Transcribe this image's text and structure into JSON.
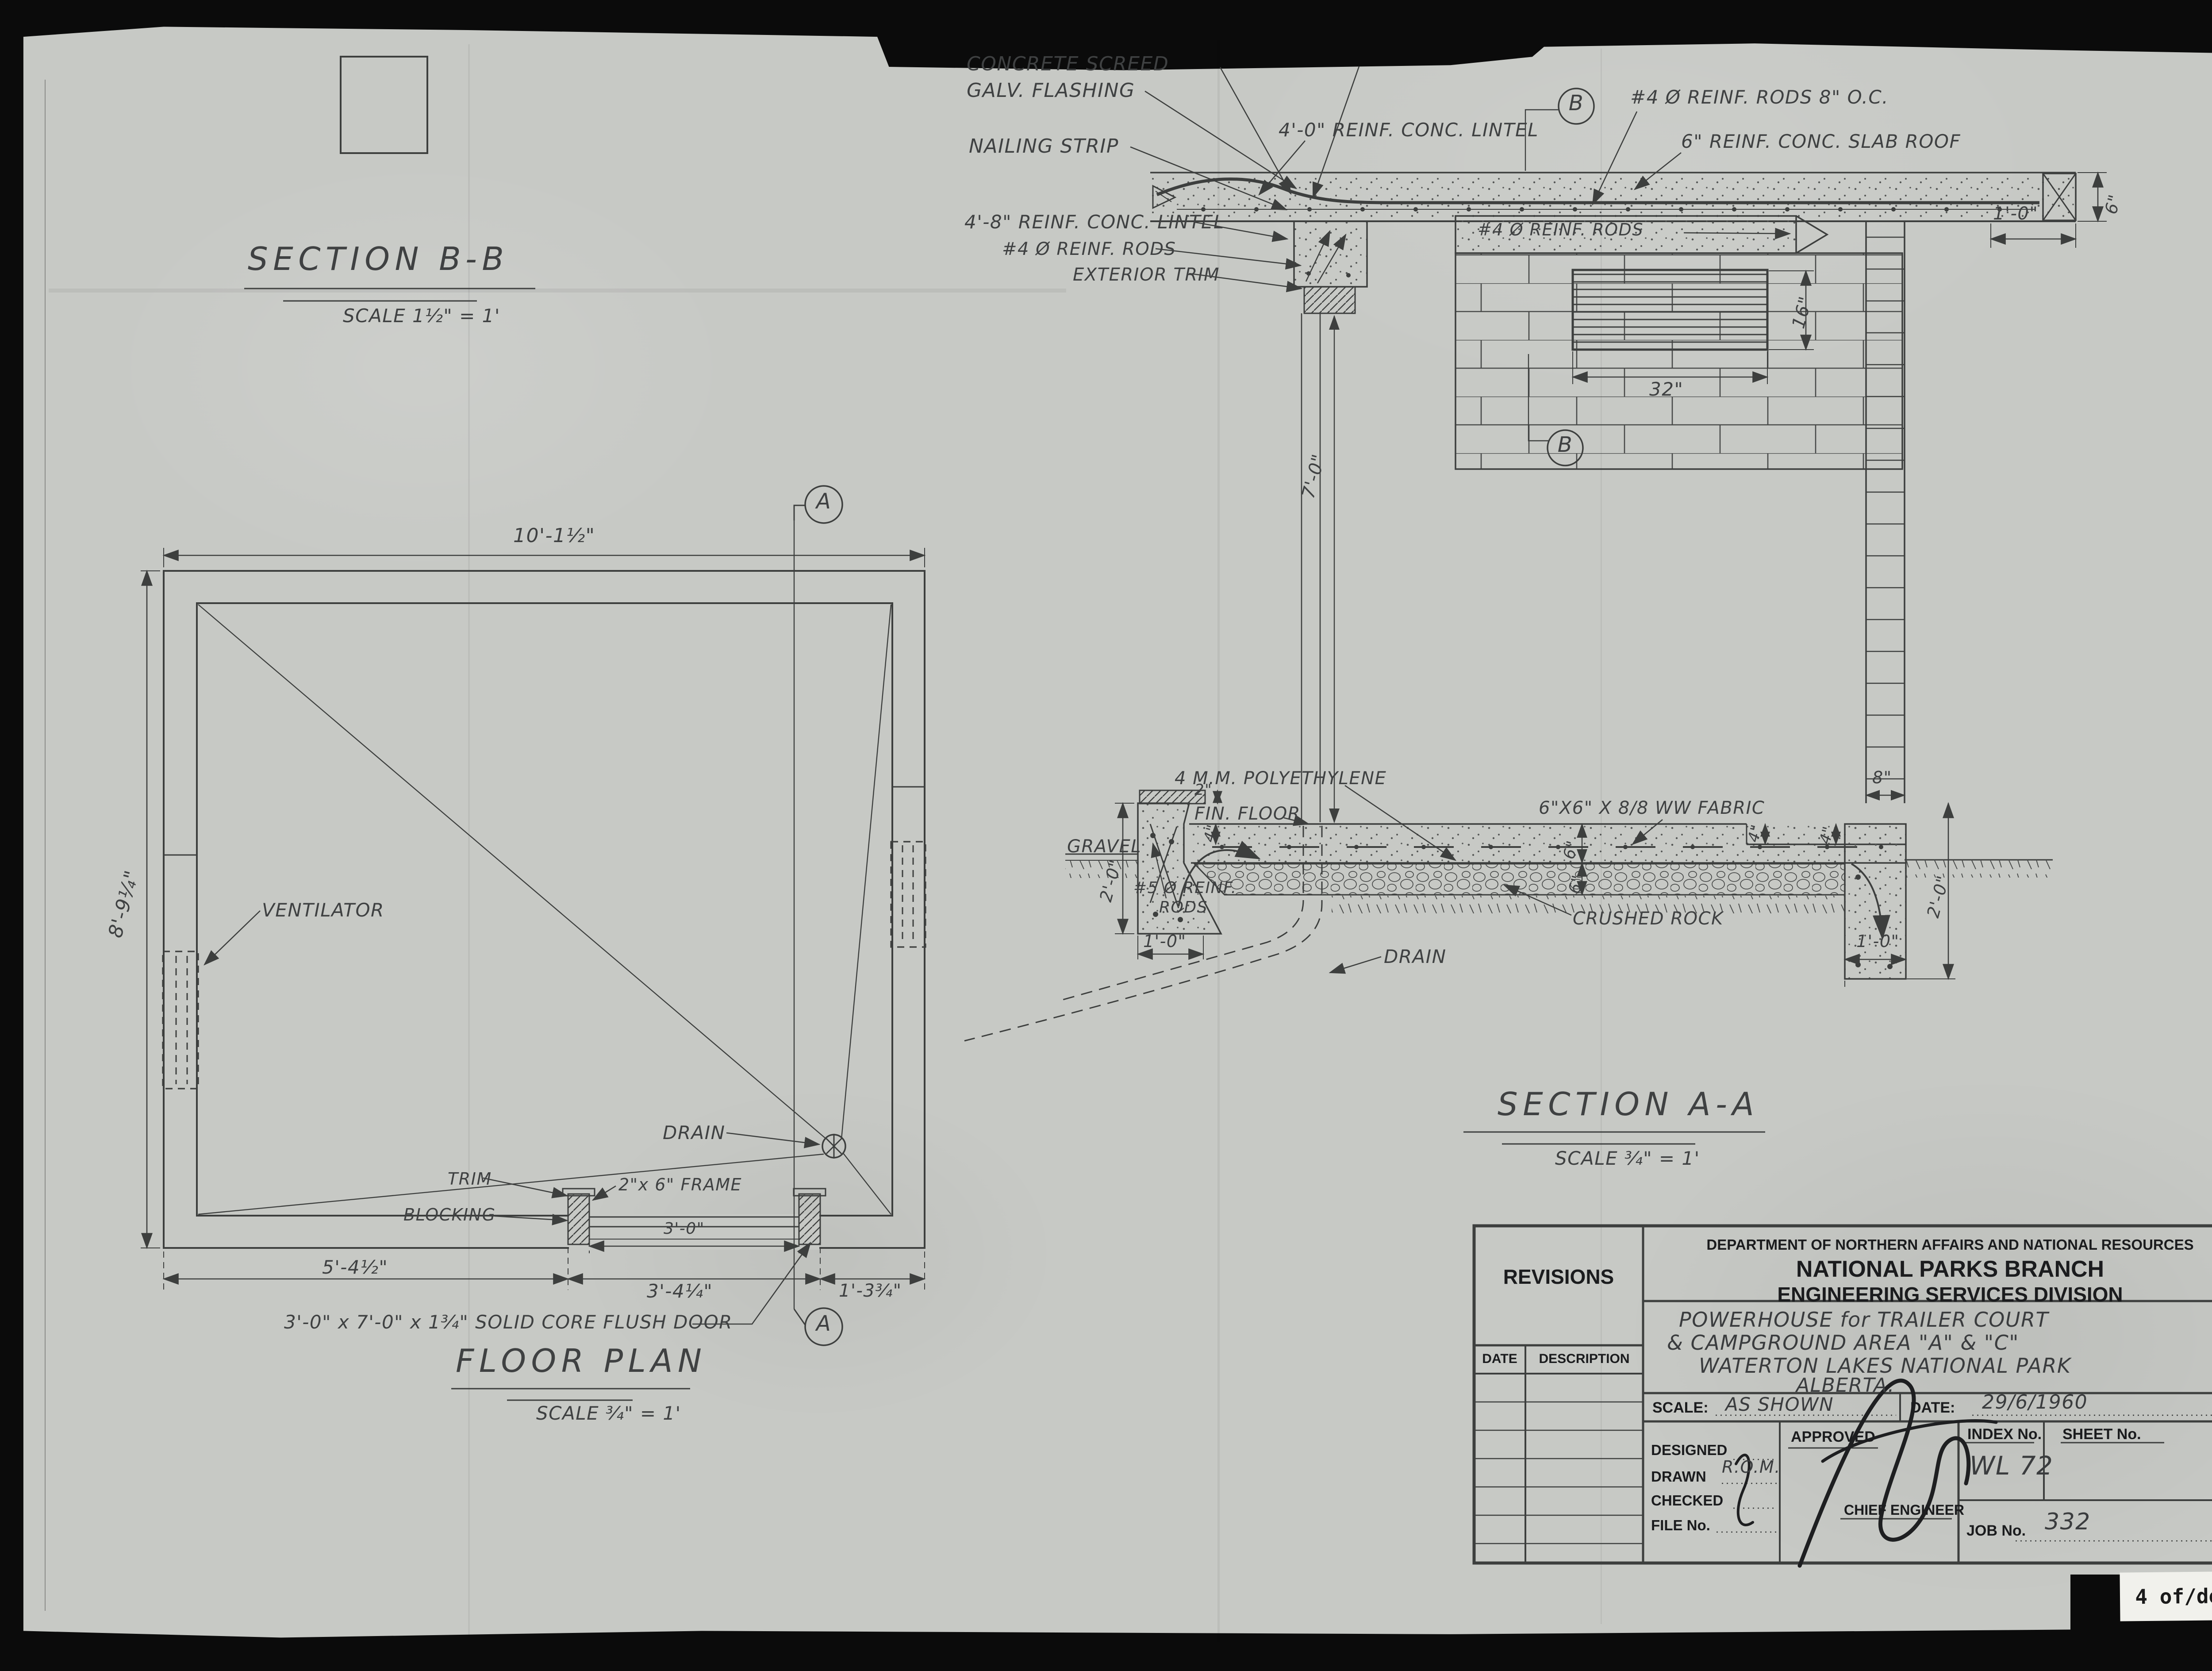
{
  "page": {
    "label": "4 of/de 4"
  },
  "floor_plan": {
    "title": "FLOOR PLAN",
    "scale": "SCALE ¾\" = 1'",
    "labels": {
      "ventilator": "VENTILATOR",
      "drain": "DRAIN",
      "trim": "TRIM",
      "blocking": "BLOCKING",
      "frame": "2\"x 6\" FRAME",
      "door_note": "3'-0\" x 7'-0\" x 1¾\" SOLID CORE FLUSH DOOR"
    },
    "dims": {
      "width": "10'-1½\"",
      "height": "8'-9¼\"",
      "door_left": "5'-4½\"",
      "door_opening": "3'-4¼\"",
      "door_right": "1'-3¾\"",
      "door_clear": "3'-0\""
    },
    "section_marker": "A"
  },
  "section_bb": {
    "title": "SECTION B-B",
    "scale": "SCALE 1½\" = 1'",
    "labels": {
      "concrete_screed": "CONCRETE SCREED",
      "galv_flashing": "GALV. FLASHING",
      "nailing_strip": "NAILING STRIP",
      "lintel_4_0": "4'-0\" REINF. CONC. LINTEL",
      "lintel_4_8": "4'-8\" REINF. CONC. LINTEL",
      "reinf_rods": "#4 Ø REINF. RODS",
      "exterior_trim": "EXTERIOR TRIM",
      "rods_8_oc": "#4 Ø REINF. RODS 8\" O.C.",
      "slab_roof": "6\" REINF. CONC. SLAB ROOF",
      "reinf_rods_wall": "#4 Ø REINF. RODS"
    },
    "dims": {
      "overhang": "1'-0\"",
      "slab_thk": "6\"",
      "louver_h": "16\"",
      "louver_w": "32\"",
      "wall_height": "7'-0\""
    },
    "section_marker": "B"
  },
  "section_aa": {
    "title": "SECTION A-A",
    "scale": "SCALE ¾\" = 1'",
    "labels": {
      "gravel": "GRAVEL",
      "poly": "4 M.M. POLYETHYLENE",
      "fin_floor": "FIN. FLOOR",
      "fabric": "6\"X6\" X 8/8 WW FABRIC",
      "rods_1": "#5 Ø REINF.",
      "rods_2": "RODS",
      "crushed_rock": "CRUSHED ROCK",
      "drain": "DRAIN"
    },
    "dims": {
      "sill": "2\"",
      "step_left": "4\"",
      "depth_left": "2'-0\"",
      "width_left": "1'-0\"",
      "slab": "6\"",
      "rock": "6\"",
      "step_right": "4\"",
      "stem": "8\"",
      "ledge": "4\"",
      "depth_right": "2'-0\"",
      "width_right": "1'-0\""
    }
  },
  "title_block": {
    "revisions": "REVISIONS",
    "date_col": "DATE",
    "description_col": "DESCRIPTION",
    "org_line1": "DEPARTMENT OF NORTHERN AFFAIRS AND NATIONAL RESOURCES",
    "org_line2": "NATIONAL PARKS BRANCH",
    "org_line3": "ENGINEERING SERVICES DIVISION",
    "project_line1": "POWERHOUSE for TRAILER COURT",
    "project_line2": "& CAMPGROUND AREA \"A\" & \"C\"",
    "project_line3": "WATERTON LAKES NATIONAL PARK",
    "project_line4": "ALBERTA.",
    "scale_label": "SCALE:",
    "scale_value": "AS SHOWN",
    "date_label": "DATE:",
    "date_value": "29/6/1960",
    "designed": "DESIGNED",
    "drawn": "DRAWN",
    "drawn_value": "R.O.M.",
    "checked": "CHECKED",
    "file_no": "FILE No.",
    "approved": "APPROVED",
    "chief_engineer": "CHIEF ENGINEER",
    "index_no": "INDEX No.",
    "index_value": "WL 72",
    "sheet_no": "SHEET No.",
    "job_no": "JOB No.",
    "job_value": "332"
  }
}
